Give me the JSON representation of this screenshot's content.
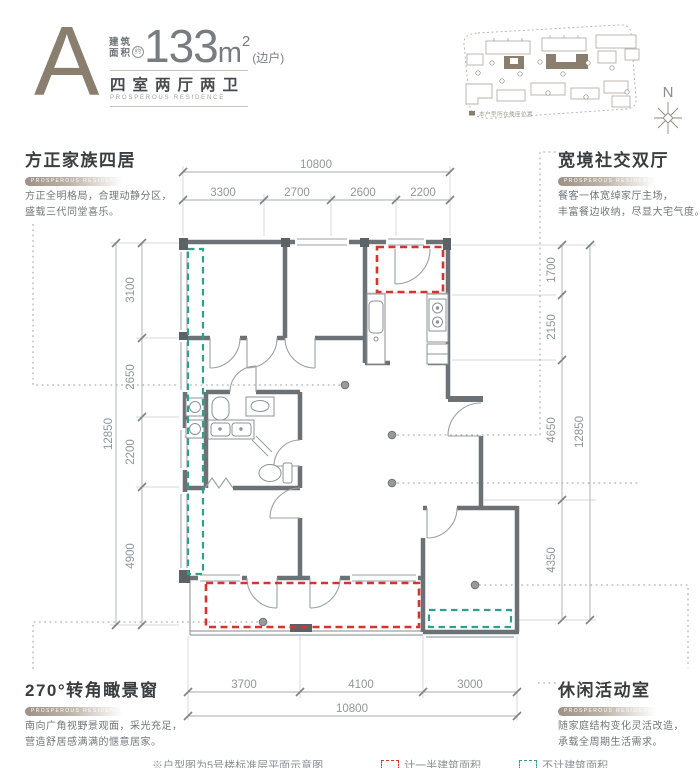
{
  "header": {
    "unit_letter": "A",
    "area_label_line1": "建筑",
    "area_label_line2": "面积",
    "area_approx": "约",
    "area_value": "133",
    "area_unit": "m",
    "area_superscript": "2",
    "area_note": "(边户)",
    "layout_name": "四室两厅两卫",
    "subtitle_en": "PROSPEROUS RESIDENCE"
  },
  "site_plan": {
    "legend": "本户型所在楼座位置",
    "compass_label": "N"
  },
  "features": {
    "top_left": {
      "title": "方正家族四居",
      "tag": "PROSPEROUS RESIDENCE",
      "line1": "方正全明格局，合理动静分区，",
      "line2": "盛载三代同堂喜乐。"
    },
    "top_right": {
      "title": "宽境社交双厅",
      "tag": "PROSPEROUS RESIDENCE",
      "line1": "餐客一体宽绰家厅主场，",
      "line2": "丰富餐边收纳，尽显大宅气度。"
    },
    "bottom_left": {
      "title": "270°转角瞰景窗",
      "tag": "PROSPEROUS RESIDENCE",
      "line1": "南向广角视野景观面，采光充足，",
      "line2": "营造舒居感满满的惬意居家。"
    },
    "bottom_right": {
      "title": "休闲活动室",
      "tag": "PROSPEROUS RESIDENCE",
      "line1": "随家庭结构变化灵活改造，",
      "line2": "承载全周期生活需求。"
    }
  },
  "dimensions": {
    "top_total": "10800",
    "top_segments": [
      "3300",
      "2700",
      "2600",
      "2200"
    ],
    "left_total": "12850",
    "left_segments": [
      "3100",
      "2650",
      "2200",
      "4900"
    ],
    "right_total": "12850",
    "right_segments": [
      "1700",
      "2150",
      "4650",
      "4350"
    ],
    "bottom_total": "10800",
    "bottom_segments": [
      "3700",
      "4100",
      "3000"
    ]
  },
  "footnote": {
    "note": "※户型图为5号楼标准层平面示意图",
    "legend_red": "计一半建筑面积",
    "legend_teal": "不计建筑面积"
  },
  "colors": {
    "accent": "#8a7e6e",
    "red_dash": "#d6352f",
    "teal_dash": "#2fa08d",
    "wall": "#6c7175"
  }
}
